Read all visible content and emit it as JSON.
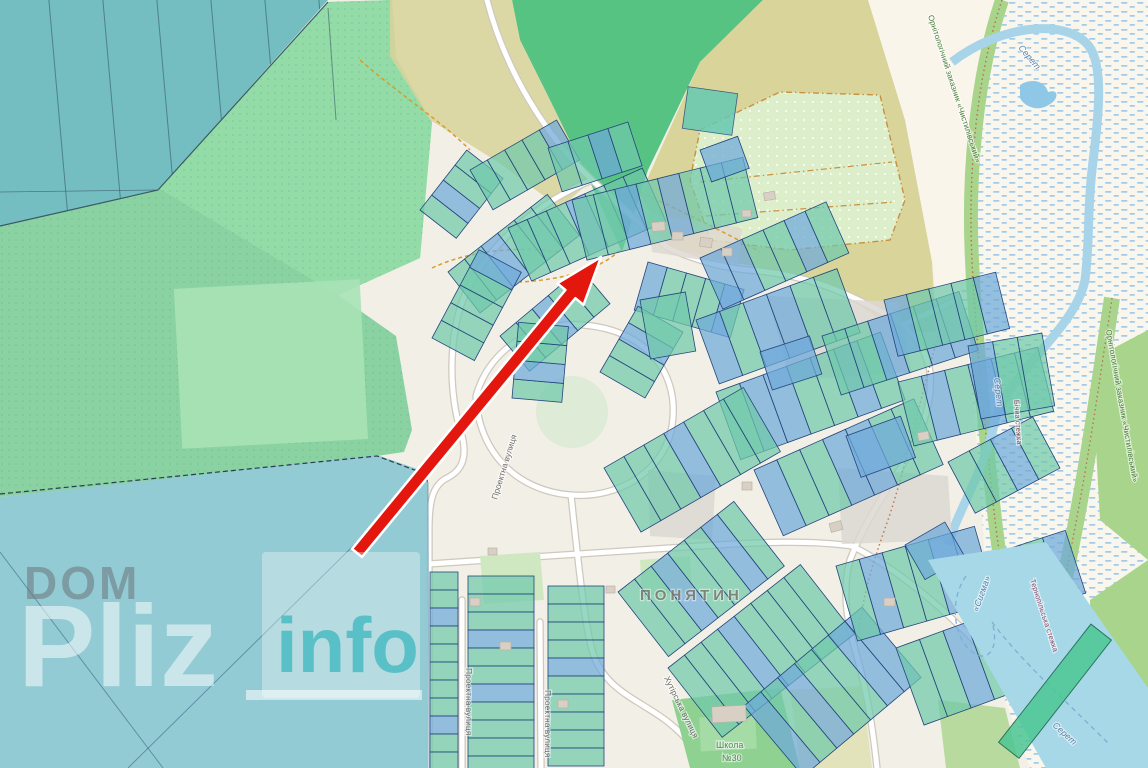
{
  "watermark": {
    "dom": "DOM",
    "pliz": "Pliz",
    "info": "info"
  },
  "labels": {
    "settlement": "ПОНЯТИН",
    "street_proektna": "Проектна вулиця",
    "street_khutirska": "Хутірська вулиця",
    "school_line1": "Школа",
    "school_line2": "№30",
    "river": "Серет",
    "reserve": "Орнітологічний заказник «Чистилівський»",
    "trail_1": "Бічна стежка",
    "trail_2": "Тернопільська стежка",
    "waterbody": "«Сигма»"
  },
  "annotation": {
    "arrow_color": "#e3170d"
  },
  "colors": {
    "parcel_teal": "#6fc9ab",
    "parcel_blue": "#6ea9da",
    "parcel_stroke": "#24457c",
    "field_green": "#8ad2a2",
    "bright_field_green": "#93dca8",
    "forest_green": "#57c383",
    "hatch_teal": "#74bec2",
    "overlay_teal": "#8fc9d3",
    "khaki": "#d8d49a",
    "marsh_dash": "#a3cbe9",
    "water": "#a6d8e8",
    "reserve_band": "#a9d48c",
    "watermark_teal": "#4ebcc3"
  }
}
